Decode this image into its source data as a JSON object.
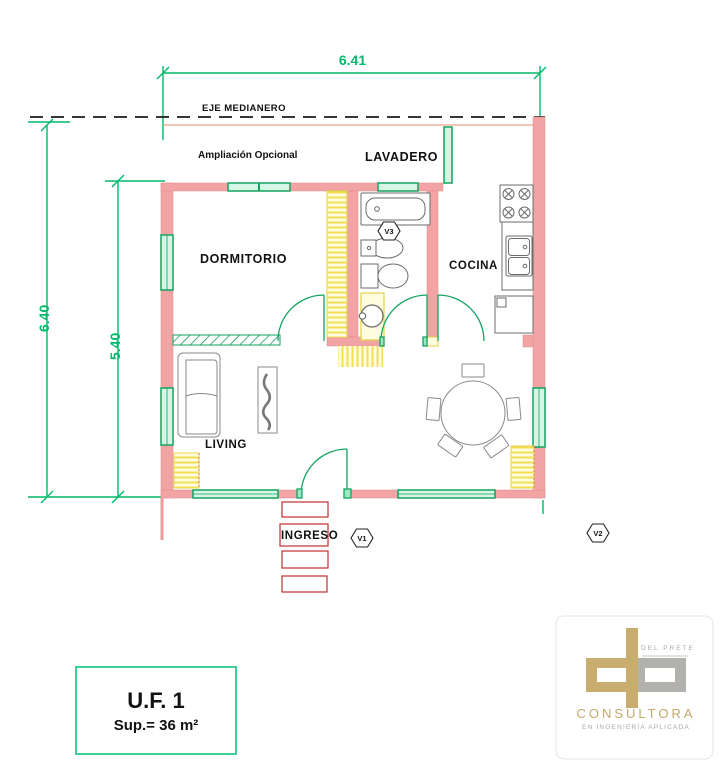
{
  "plan": {
    "dim_top": "6.41",
    "dim_left_outer": "6.40",
    "dim_left_inner": "5.40",
    "eje_medianero": "EJE MEDIANERO",
    "ampliacion": "Ampliación Opcional",
    "rooms": {
      "lavadero": "LAVADERO",
      "dormitorio": "DORMITORIO",
      "cocina": "COCINA",
      "living": "LIVING",
      "ingreso": "INGRESO"
    },
    "markers": {
      "v1": "V1",
      "v2": "V2",
      "v3": "V3"
    }
  },
  "unit_box": {
    "title": "U.F. 1",
    "area": "Sup.= 36 m²"
  },
  "logo": {
    "brand": "DEL PRETE",
    "company": "CONSULTORA",
    "tagline": "EN INGENIERÍA APLICADA"
  },
  "colors": {
    "wall": "#F2A3A3",
    "window_green": "#12A35F",
    "dimension_green": "#00B96B",
    "hatch_yellow": "#F2DE52",
    "step_red": "#C23030",
    "logo_gold": "#C8AD6E",
    "logo_gray": "#B3B1AE"
  }
}
